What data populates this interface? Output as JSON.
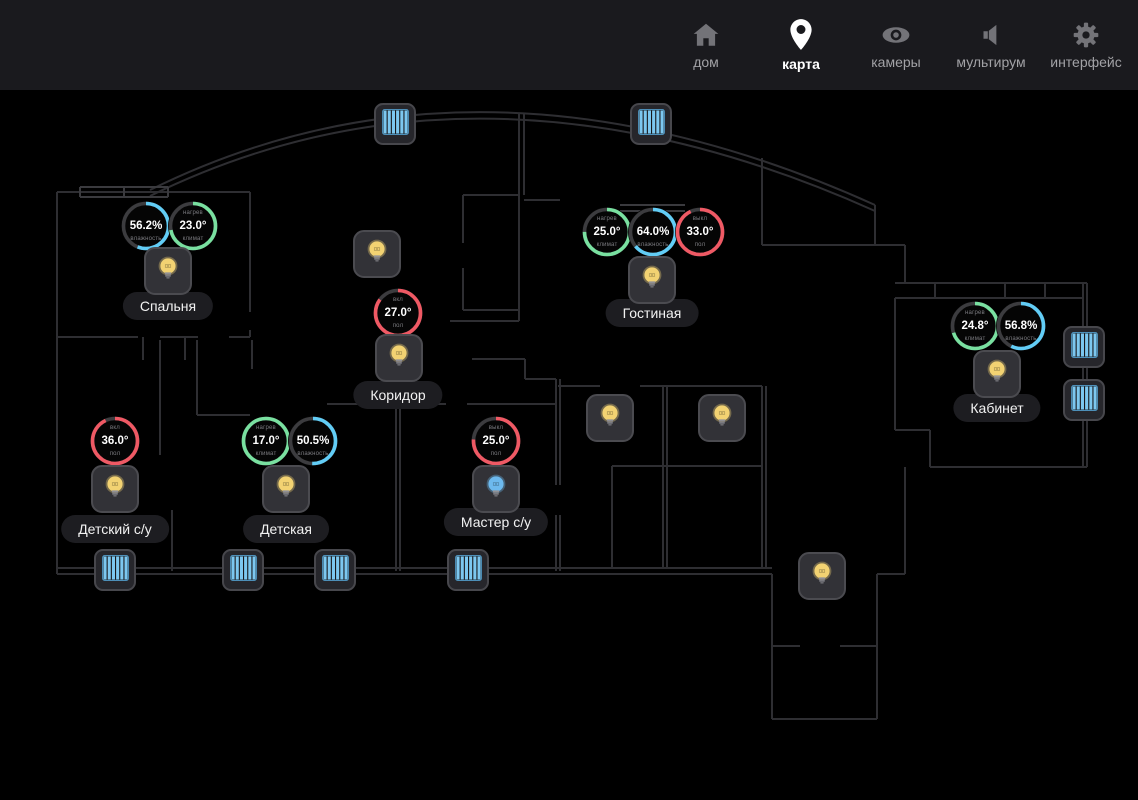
{
  "header": {
    "items": [
      {
        "id": "home",
        "label": "дом",
        "icon": "home-icon",
        "active": false
      },
      {
        "id": "map",
        "label": "карта",
        "icon": "map-pin-icon",
        "active": true
      },
      {
        "id": "cameras",
        "label": "камеры",
        "icon": "eye-icon",
        "active": false
      },
      {
        "id": "multiroom",
        "label": "мультирум",
        "icon": "speaker-icon",
        "active": false
      },
      {
        "id": "interface",
        "label": "интерфейс",
        "icon": "gear-icon",
        "active": false
      }
    ]
  },
  "colors": {
    "topbar_bg": "#1a1a1e",
    "plan_bg": "#000000",
    "wall": "#2e2e32",
    "accent_green": "#79e0a0",
    "accent_blue": "#62cdf6",
    "accent_red": "#ef5964",
    "gauge_track": "#3c3c3f",
    "bulb_yellow": "#f2d272",
    "bulb_blue": "#6db9ee",
    "blind_blue": "#7cc7ef"
  },
  "map": {
    "rooms": [
      {
        "name": "bedroom",
        "label": "Спальня",
        "x": 168,
        "y": 216
      },
      {
        "name": "living-room",
        "label": "Гостиная",
        "x": 652,
        "y": 223
      },
      {
        "name": "corridor",
        "label": "Коридор",
        "x": 398,
        "y": 305
      },
      {
        "name": "office",
        "label": "Кабинет",
        "x": 997,
        "y": 318
      },
      {
        "name": "kids-bathroom",
        "label": "Детский с/у",
        "x": 115,
        "y": 439
      },
      {
        "name": "kids-room",
        "label": "Детская",
        "x": 286,
        "y": 439
      },
      {
        "name": "master-bathroom",
        "label": "Мастер с/у",
        "x": 496,
        "y": 432
      }
    ],
    "gauges": [
      {
        "room": "bedroom",
        "type": "humidity",
        "x": 146,
        "y": 136,
        "top_label": "",
        "value": "56.2%",
        "bottom_label": "влажность",
        "color": "blue",
        "fraction": 0.56
      },
      {
        "room": "bedroom",
        "type": "climate",
        "x": 193,
        "y": 136,
        "top_label": "нагрев",
        "value": "23.0°",
        "bottom_label": "климат",
        "color": "green",
        "fraction": 0.72
      },
      {
        "room": "living-room",
        "type": "climate",
        "x": 607,
        "y": 142,
        "top_label": "нагрев",
        "value": "25.0°",
        "bottom_label": "климат",
        "color": "green",
        "fraction": 0.75
      },
      {
        "room": "living-room",
        "type": "humidity",
        "x": 653,
        "y": 142,
        "top_label": "",
        "value": "64.0%",
        "bottom_label": "влажность",
        "color": "blue",
        "fraction": 0.64
      },
      {
        "room": "living-room",
        "type": "floor",
        "x": 700,
        "y": 142,
        "top_label": "выкл",
        "value": "33.0°",
        "bottom_label": "пол",
        "color": "red",
        "fraction": 0.93
      },
      {
        "room": "corridor",
        "type": "floor",
        "x": 398,
        "y": 223,
        "top_label": "вкл",
        "value": "27.0°",
        "bottom_label": "пол",
        "color": "red",
        "fraction": 0.85
      },
      {
        "room": "office",
        "type": "climate",
        "x": 975,
        "y": 236,
        "top_label": "нагрев",
        "value": "24.8°",
        "bottom_label": "климат",
        "color": "green",
        "fraction": 0.7
      },
      {
        "room": "office",
        "type": "humidity",
        "x": 1021,
        "y": 236,
        "top_label": "",
        "value": "56.8%",
        "bottom_label": "влажность",
        "color": "blue",
        "fraction": 0.57
      },
      {
        "room": "kids-bathroom",
        "type": "floor",
        "x": 115,
        "y": 351,
        "top_label": "вкл",
        "value": "36.0°",
        "bottom_label": "пол",
        "color": "red",
        "fraction": 0.93
      },
      {
        "room": "kids-room",
        "type": "climate",
        "x": 266,
        "y": 351,
        "top_label": "нагрев",
        "value": "17.0°",
        "bottom_label": "климат",
        "color": "green",
        "fraction": 1.0
      },
      {
        "room": "kids-room",
        "type": "humidity",
        "x": 313,
        "y": 351,
        "top_label": "",
        "value": "50.5%",
        "bottom_label": "влажность",
        "color": "blue",
        "fraction": 0.505
      },
      {
        "room": "master-bathroom",
        "type": "floor",
        "x": 496,
        "y": 351,
        "top_label": "выкл",
        "value": "25.0°",
        "bottom_label": "пол",
        "color": "red",
        "fraction": 0.76
      }
    ],
    "lights": [
      {
        "room": "bedroom",
        "x": 168,
        "y": 181,
        "state": "yellow"
      },
      {
        "room": "corridor",
        "x": 377,
        "y": 164,
        "state": "yellow"
      },
      {
        "room": "corridor",
        "x": 399,
        "y": 268,
        "state": "yellow"
      },
      {
        "room": "living-room",
        "x": 652,
        "y": 190,
        "state": "yellow"
      },
      {
        "room": "office",
        "x": 997,
        "y": 284,
        "state": "yellow"
      },
      {
        "room": "kids-bathroom",
        "x": 115,
        "y": 399,
        "state": "yellow"
      },
      {
        "room": "kids-room",
        "x": 286,
        "y": 399,
        "state": "yellow"
      },
      {
        "room": "master-bathroom",
        "x": 496,
        "y": 399,
        "state": "blue"
      },
      {
        "room": "",
        "x": 610,
        "y": 328,
        "state": "yellow"
      },
      {
        "room": "",
        "x": 722,
        "y": 328,
        "state": "yellow"
      },
      {
        "room": "",
        "x": 822,
        "y": 486,
        "state": "yellow"
      }
    ],
    "blinds": [
      {
        "x": 395,
        "y": 34
      },
      {
        "x": 651,
        "y": 34
      },
      {
        "x": 1084,
        "y": 257
      },
      {
        "x": 1084,
        "y": 310
      },
      {
        "x": 115,
        "y": 480
      },
      {
        "x": 243,
        "y": 480
      },
      {
        "x": 335,
        "y": 480
      },
      {
        "x": 468,
        "y": 480
      }
    ]
  }
}
